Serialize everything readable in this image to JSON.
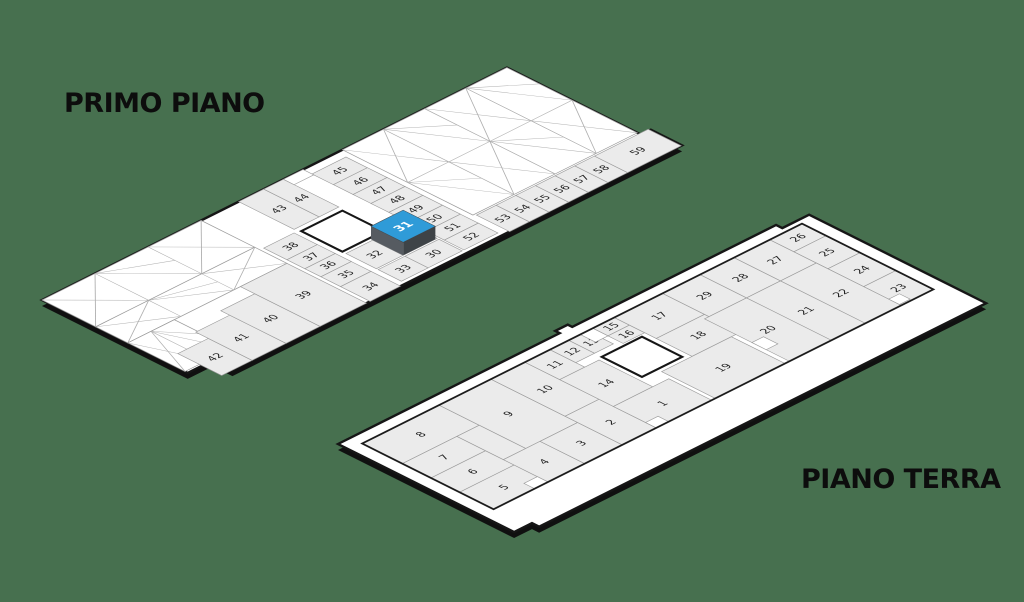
{
  "background_color": "#47704f",
  "titles": {
    "floor1": "PRIMO PIANO",
    "floor2": "PIANO TERRA"
  },
  "palette": {
    "slab": "#ffffff",
    "shadow": "#101010",
    "outline": "#161616",
    "inner_line": "#1c1c1c",
    "cell": "#ebebeb",
    "cell_line": "#9b9b9b",
    "truss_line": "#aeaeae",
    "label": "#222222",
    "highlight_top": "#2f9bd8",
    "highlight_left": "#565b61",
    "highlight_right": "#3e4347",
    "highlight_text": "#ffffff"
  },
  "floors": [
    {
      "key": "primo-piano",
      "origin": [
        42,
        300
      ],
      "outline": [
        [
          0,
          0
        ],
        [
          520,
          0
        ],
        [
          520,
          150
        ],
        [
          531,
          150
        ],
        [
          531,
          185
        ],
        [
          28,
          185
        ],
        [
          28,
          163
        ],
        [
          0,
          163
        ]
      ],
      "truss": [
        [
          0,
          0,
          178,
          60
        ],
        [
          0,
          60,
          178,
          36
        ],
        [
          0,
          96,
          52,
          64
        ],
        [
          336,
          0,
          184,
          146
        ]
      ],
      "inner": null,
      "atrium": [
        222,
        68,
        46,
        46
      ],
      "patches": [
        [
          270,
          0,
          22,
          12
        ]
      ],
      "units": [
        [
          "42",
          16,
          136,
          34,
          49
        ],
        [
          "41",
          50,
          122,
          38,
          63
        ],
        [
          "40",
          88,
          112,
          38,
          73
        ],
        [
          "39",
          126,
          96,
          52,
          89
        ],
        [
          "38",
          182,
          66,
          34,
          26
        ],
        [
          "37",
          182,
          92,
          34,
          20
        ],
        [
          "36",
          182,
          112,
          34,
          18
        ],
        [
          "35",
          182,
          130,
          34,
          22
        ],
        [
          "34",
          182,
          152,
          34,
          33
        ],
        [
          "43",
          220,
          0,
          28,
          62
        ],
        [
          "44",
          248,
          0,
          22,
          62
        ],
        [
          "45",
          292,
          10,
          38,
          24
        ],
        [
          "46",
          292,
          34,
          38,
          22
        ],
        [
          "47",
          292,
          56,
          38,
          20
        ],
        [
          "48",
          292,
          76,
          38,
          20
        ],
        [
          "49",
          292,
          96,
          38,
          22
        ],
        [
          "50",
          292,
          118,
          38,
          20
        ],
        [
          "51",
          292,
          138,
          38,
          20
        ],
        [
          "52",
          292,
          158,
          38,
          22
        ],
        [
          "32",
          222,
          118,
          30,
          34
        ],
        [
          "",
          252,
          118,
          38,
          34
        ],
        [
          "33",
          222,
          154,
          30,
          26
        ],
        [
          "30",
          252,
          154,
          38,
          26
        ],
        [
          "53",
          338,
          148,
          22,
          37
        ],
        [
          "54",
          360,
          148,
          22,
          37
        ],
        [
          "55",
          382,
          148,
          22,
          37
        ],
        [
          "56",
          404,
          148,
          22,
          37
        ],
        [
          "57",
          426,
          148,
          22,
          37
        ],
        [
          "58",
          448,
          148,
          22,
          37
        ],
        [
          "59",
          470,
          148,
          60,
          37
        ]
      ],
      "highlight": {
        "n": "31",
        "rect": [
          252,
          116,
          36,
          36
        ],
        "height": 13
      }
    },
    {
      "key": "piano-terra",
      "origin": [
        338,
        444
      ],
      "outline": [
        [
          0,
          0
        ],
        [
          248,
          0
        ],
        [
          248,
          -5
        ],
        [
          262,
          -5
        ],
        [
          262,
          0
        ],
        [
          490,
          0
        ],
        [
          490,
          7
        ],
        [
          520,
          7
        ],
        [
          520,
          205
        ],
        [
          20,
          205
        ],
        [
          20,
          197
        ],
        [
          0,
          197
        ]
      ],
      "truss": [],
      "inner": [
        14,
        13,
        492,
        147
      ],
      "atrium": [
        245,
        50,
        45,
        45
      ],
      "patches": [
        [
          258,
          13,
          14,
          17
        ],
        [
          345,
          118,
          13,
          16
        ],
        [
          470,
          146,
          12,
          12
        ],
        [
          60,
          148,
          15,
          12
        ],
        [
          196,
          148,
          14,
          12
        ]
      ],
      "units": [
        [
          "8",
          14,
          13,
          86,
          45
        ],
        [
          "7",
          14,
          58,
          61,
          32
        ],
        [
          "6",
          14,
          90,
          61,
          32
        ],
        [
          "5",
          14,
          122,
          61,
          38
        ],
        [
          "9",
          100,
          13,
          58,
          97
        ],
        [
          "",
          75,
          58,
          25,
          52
        ],
        [
          "4",
          75,
          110,
          41,
          50
        ],
        [
          "3",
          116,
          110,
          42,
          50
        ],
        [
          "10",
          158,
          13,
          38,
          83
        ],
        [
          "2",
          158,
          96,
          38,
          64
        ],
        [
          "11",
          196,
          13,
          28,
          39
        ],
        [
          "12",
          224,
          13,
          21,
          29
        ],
        [
          "13",
          245,
          13,
          21,
          29
        ],
        [
          "14",
          196,
          52,
          44,
          60
        ],
        [
          "1",
          196,
          112,
          62,
          48
        ],
        [
          "15",
          272,
          13,
          24,
          17
        ],
        [
          "16",
          272,
          30,
          24,
          17
        ],
        [
          "17",
          296,
          13,
          54,
          47
        ],
        [
          "18",
          296,
          60,
          54,
          40
        ],
        [
          "19",
          262,
          100,
          78,
          60
        ],
        [
          "29",
          350,
          13,
          42,
          52
        ],
        [
          "28",
          392,
          13,
          38,
          52
        ],
        [
          "27",
          430,
          13,
          40,
          52
        ],
        [
          "26",
          470,
          13,
          36,
          27
        ],
        [
          "25",
          470,
          40,
          36,
          38
        ],
        [
          "24",
          470,
          78,
          36,
          40
        ],
        [
          "23",
          470,
          118,
          36,
          42
        ],
        [
          "20",
          345,
          65,
          47,
          95
        ],
        [
          "21",
          392,
          65,
          38,
          95
        ],
        [
          "22",
          430,
          65,
          40,
          95
        ]
      ],
      "highlight": null
    }
  ]
}
